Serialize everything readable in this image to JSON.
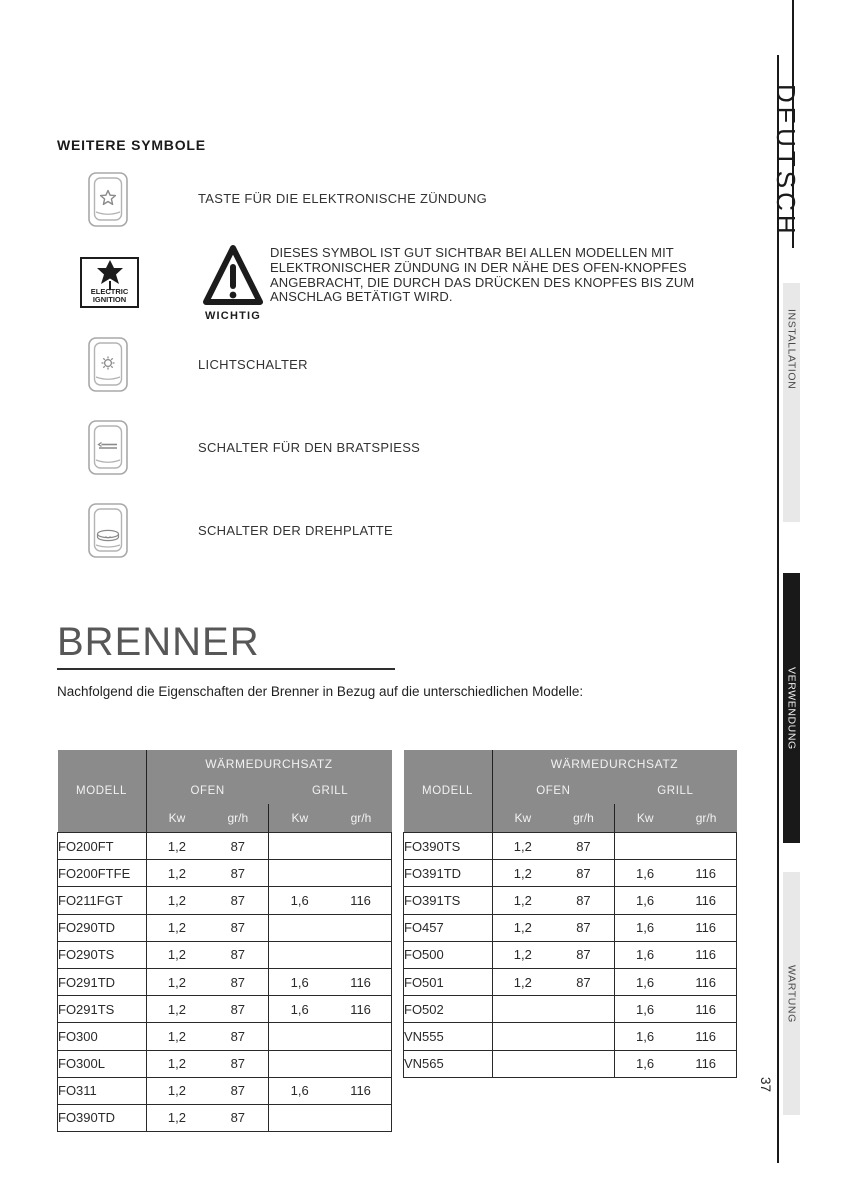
{
  "page": {
    "number": "37",
    "language_tab": "DEUTSCH",
    "colors": {
      "table_header_gray": "#8b8b8b",
      "sidebar_tab_dark": "#191919",
      "sidebar_tab_light": "#e8e8e8"
    }
  },
  "sidebar": {
    "tabs": [
      {
        "label": "INSTALLATION",
        "style": "light"
      },
      {
        "label": "VERWENDUNG",
        "style": "dark"
      },
      {
        "label": "WARTUNG",
        "style": "light"
      }
    ]
  },
  "symbols_section": {
    "heading": "WEITERE SYMBOLE",
    "items": [
      {
        "icon": "ignition-button-icon",
        "label": "TASTE FÜR DIE ELEKTRONISCHE ZÜNDUNG"
      },
      {
        "icon": "light-switch-icon",
        "label": "LICHTSCHALTER"
      },
      {
        "icon": "rotisserie-switch-icon",
        "label": "SCHALTER FÜR DEN BRATSPIESS"
      },
      {
        "icon": "turntable-switch-icon",
        "label": "SCHALTER DER DREHPLATTE"
      }
    ],
    "electric_ignition": {
      "icon": "electric-ignition-icon",
      "lines": [
        "ELECTRIC",
        "IGNITION"
      ]
    },
    "warning": {
      "icon": "warning-triangle-icon",
      "caption": "WICHTIG",
      "lines": [
        "DIESES SYMBOL IST GUT SICHTBAR BEI ALLEN MODELLEN MIT",
        "ELEKTRONISCHER ZÜNDUNG IN DER NÄHE DES OFEN-KNOPFES",
        "ANGEBRACHT, DIE DURCH DAS DRÜCKEN DES KNOPFES BIS ZUM",
        "ANSCHLAG BETÄTIGT WIRD."
      ]
    }
  },
  "brenner_section": {
    "heading": "BRENNER",
    "intro": "Nachfolgend die Eigenschaften der Brenner in Bezug auf die unterschiedlichen Modelle:",
    "header": {
      "model": "MODELL",
      "group": "WÄRMEDURCHSATZ",
      "sub_ofen": "OFEN",
      "sub_grill": "GRILL",
      "unit_kw": "Kw",
      "unit_grh": "gr/h"
    },
    "table_left_rows": [
      [
        "FO200FT",
        "1,2",
        "87",
        "",
        ""
      ],
      [
        "FO200FTFE",
        "1,2",
        "87",
        "",
        ""
      ],
      [
        "FO211FGT",
        "1,2",
        "87",
        "1,6",
        "116"
      ],
      [
        "FO290TD",
        "1,2",
        "87",
        "",
        ""
      ],
      [
        "FO290TS",
        "1,2",
        "87",
        "",
        ""
      ],
      [
        "FO291TD",
        "1,2",
        "87",
        "1,6",
        "116"
      ],
      [
        "FO291TS",
        "1,2",
        "87",
        "1,6",
        "116"
      ],
      [
        "FO300",
        "1,2",
        "87",
        "",
        ""
      ],
      [
        "FO300L",
        "1,2",
        "87",
        "",
        ""
      ],
      [
        "FO311",
        "1,2",
        "87",
        "1,6",
        "116"
      ],
      [
        "FO390TD",
        "1,2",
        "87",
        "",
        ""
      ]
    ],
    "table_right_rows": [
      [
        "FO390TS",
        "1,2",
        "87",
        "",
        ""
      ],
      [
        "FO391TD",
        "1,2",
        "87",
        "1,6",
        "116"
      ],
      [
        "FO391TS",
        "1,2",
        "87",
        "1,6",
        "116"
      ],
      [
        "FO457",
        "1,2",
        "87",
        "1,6",
        "116"
      ],
      [
        "FO500",
        "1,2",
        "87",
        "1,6",
        "116"
      ],
      [
        "FO501",
        "1,2",
        "87",
        "1,6",
        "116"
      ],
      [
        "FO502",
        "",
        "",
        "1,6",
        "116"
      ],
      [
        "VN555",
        "",
        "",
        "1,6",
        "116"
      ],
      [
        "VN565",
        "",
        "",
        "1,6",
        "116"
      ]
    ]
  }
}
